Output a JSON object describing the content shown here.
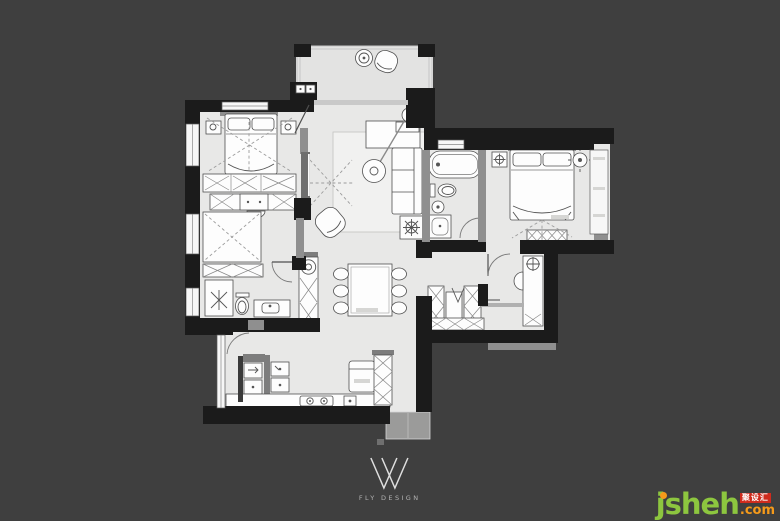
{
  "canvas": {
    "width": 780,
    "height": 520,
    "background": "#3f3f3f"
  },
  "plan": {
    "kind": "residential-floor-plan",
    "colors": {
      "floor": "#e8e8e7",
      "exterior_wall": "#1b1b1b",
      "interior_wall": "#8f8f8f",
      "furniture_fill": "#fdfdfd",
      "furniture_stroke": "#4f4f4f",
      "rug": "#f1f1f0",
      "dashed_guides": "#9c9c9c"
    }
  },
  "logo": {
    "brand": "FLY DESIGN"
  },
  "watermark": {
    "site_name": "jsheh",
    "tld": ".com",
    "badge": "聚设汇",
    "name_color": "#8dc63f",
    "tld_color": "#f59a1a",
    "badge_color": "#cf2b1d",
    "j_dot_color": "#f59a1a"
  }
}
